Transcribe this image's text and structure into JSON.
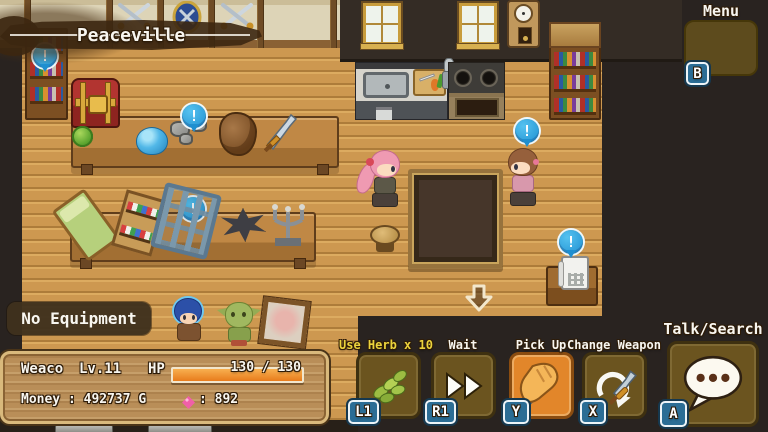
{
  "hud": {
    "location_banner": "Peaceville",
    "menu": {
      "label": "Menu",
      "badge": "B",
      "icon": "grid-icon"
    },
    "equipment_status": "No Equipment",
    "status_panel": {
      "character_name": "Weaco",
      "level": "Lv.11",
      "hp_label": "HP",
      "hp_text": "130 / 130",
      "hp_percent": 100,
      "money_text": "Money : 492737 G",
      "gem_text": ": 892",
      "gem_icon": "pink-gem-icon"
    },
    "actions": [
      {
        "label": "Use Herb x 10",
        "badge": "L1",
        "icon": "herb-icon",
        "highlighted": false
      },
      {
        "label": "Wait",
        "badge": "R1",
        "icon": "fast-forward-icon",
        "highlighted": false
      },
      {
        "label": "Pick Up",
        "badge": "Y",
        "icon": "glove-sword-icon",
        "highlighted": true
      },
      {
        "label": "Change Weapon",
        "badge": "X",
        "icon": "swap-sword-icon",
        "highlighted": false
      },
      {
        "label": "Talk/Search",
        "badge": "A",
        "icon": "speech-bubble-icon",
        "highlighted": false,
        "large": true
      }
    ],
    "interaction_marker": "!",
    "exit_arrow_icon": "down-arrow-icon"
  },
  "colors": {
    "highlight_orange": "#e2862a",
    "button_brown": "#6b541f",
    "badge_blue": "#2b6d95",
    "marker_blue": "#2aa6e2",
    "panel_wood": "#b98e58",
    "panel_border": "#d9b97c",
    "hp_bar": "#ef8a20",
    "herb_label_yellow": "#ecd33c",
    "gem_pink": "#f05fa8"
  },
  "scene": {
    "location": "shop interior",
    "objects": [
      "bookshelf",
      "treasure-chest",
      "cabbages",
      "display-table",
      "slime-gel",
      "ore-rocks",
      "hide-chunk",
      "sword",
      "bed",
      "potion-shelf",
      "iron-rack",
      "spike-ball",
      "candelabra",
      "kitchen-sink",
      "cutting-board",
      "stove",
      "window",
      "grandfather-clock",
      "dining-table",
      "stool",
      "telephone",
      "pink-haired-villager",
      "brown-haired-villager",
      "blue-haired-hero",
      "goblin-companion",
      "portrait-frame"
    ]
  }
}
